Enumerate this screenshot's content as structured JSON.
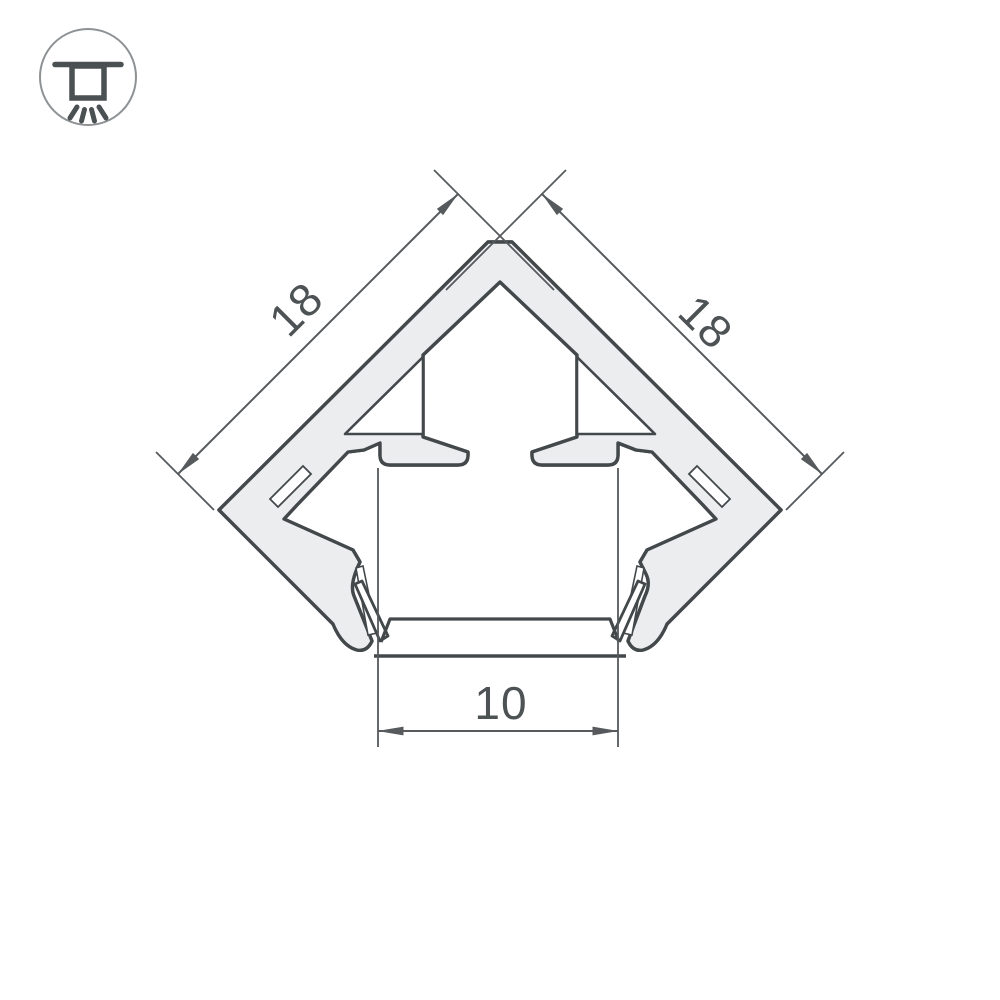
{
  "drawing": {
    "type": "profile-cross-section",
    "dimensions": {
      "left": "18",
      "right": "18",
      "bottom": "10"
    },
    "icon": {
      "name": "recessed-ceiling-light",
      "description": "circle badge with downlight glyph and light rays"
    },
    "colors": {
      "background": "#ffffff",
      "outline": "#43484b",
      "metal_fill": "#ecedee",
      "hatch": "#767b7e",
      "dimension_line": "#565a5c",
      "dimension_text": "#4d5254",
      "icon_circle": "#8e9294",
      "icon_glyph": "#4b5053"
    }
  }
}
